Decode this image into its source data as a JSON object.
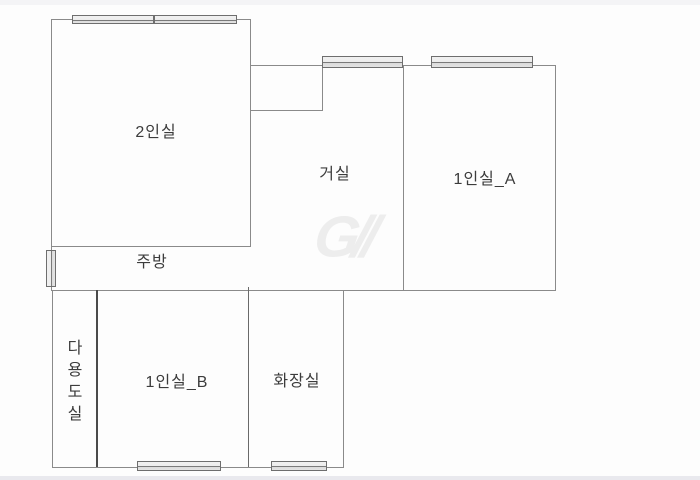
{
  "floorplan": {
    "canvas": {
      "width": 700,
      "height": 480,
      "background": "#fdfdfd"
    },
    "bands": [
      {
        "name": "top-edge-band",
        "y": 0,
        "h": 5,
        "color": "#f4f4f6"
      },
      {
        "name": "bottom-edge-band",
        "y": 476,
        "h": 4,
        "color": "#e9e9ee"
      }
    ],
    "wall_default_color": "#8a8a8a",
    "walls": [
      {
        "name": "room2in-top-wall",
        "x": 51,
        "y": 19,
        "w": 200,
        "h": 1
      },
      {
        "name": "room2in-left-wall",
        "x": 51,
        "y": 19,
        "w": 1,
        "h": 228
      },
      {
        "name": "room2in-right-wall",
        "x": 250,
        "y": 19,
        "w": 1,
        "h": 228
      },
      {
        "name": "room2in-bottom-wall",
        "x": 51,
        "y": 246,
        "w": 200,
        "h": 1
      },
      {
        "name": "upper-top-wall",
        "x": 250,
        "y": 65,
        "w": 306,
        "h": 1
      },
      {
        "name": "notch-right-wall",
        "x": 322,
        "y": 65,
        "w": 1,
        "h": 46
      },
      {
        "name": "notch-bottom-wall",
        "x": 250,
        "y": 110,
        "w": 73,
        "h": 1
      },
      {
        "name": "living-1inA-divider",
        "x": 403,
        "y": 65,
        "w": 1,
        "h": 226
      },
      {
        "name": "room1inA-right-wall",
        "x": 555,
        "y": 65,
        "w": 1,
        "h": 226
      },
      {
        "name": "mid-horizontal-wall",
        "x": 52,
        "y": 290,
        "w": 504,
        "h": 1
      },
      {
        "name": "kitchen-left-wall",
        "x": 51,
        "y": 246,
        "w": 1,
        "h": 45
      },
      {
        "name": "lower-left-wall",
        "x": 52,
        "y": 290,
        "w": 1,
        "h": 178
      },
      {
        "name": "utility-divider-wall",
        "x": 96,
        "y": 290,
        "w": 2,
        "h": 178,
        "color": "#4a4a4a"
      },
      {
        "name": "room1inB-bath-divider",
        "x": 248,
        "y": 287,
        "w": 1,
        "h": 181,
        "color": "#6a6a6a"
      },
      {
        "name": "bath-right-wall",
        "x": 343,
        "y": 291,
        "w": 1,
        "h": 177
      },
      {
        "name": "lower-bottom-wall",
        "x": 52,
        "y": 467,
        "w": 292,
        "h": 1
      }
    ],
    "windows": [
      {
        "name": "room2in-window-left",
        "x": 72,
        "y": 15,
        "w": 82,
        "h": 9,
        "vertical": false
      },
      {
        "name": "room2in-window-right",
        "x": 154,
        "y": 15,
        "w": 83,
        "h": 9,
        "vertical": false
      },
      {
        "name": "living-window",
        "x": 322,
        "y": 56,
        "w": 81,
        "h": 12,
        "vertical": false
      },
      {
        "name": "room1inA-window",
        "x": 431,
        "y": 56,
        "w": 102,
        "h": 12,
        "vertical": false
      },
      {
        "name": "kitchen-side-window",
        "x": 46,
        "y": 250,
        "w": 10,
        "h": 37,
        "vertical": true
      },
      {
        "name": "room1inB-window",
        "x": 137,
        "y": 461,
        "w": 84,
        "h": 10,
        "vertical": false
      },
      {
        "name": "bath-window",
        "x": 271,
        "y": 461,
        "w": 56,
        "h": 10,
        "vertical": false
      }
    ],
    "rooms": [
      {
        "id": "room-label-2insil",
        "label": "2인실",
        "cx": 156,
        "cy": 130,
        "vertical": false
      },
      {
        "id": "room-label-geosil",
        "label": "거실",
        "cx": 335,
        "cy": 172,
        "vertical": false
      },
      {
        "id": "room-label-1insil-a",
        "label": "1인실_A",
        "cx": 485,
        "cy": 177,
        "vertical": false
      },
      {
        "id": "room-label-jubang",
        "label": "주방",
        "cx": 152,
        "cy": 260,
        "vertical": false
      },
      {
        "id": "room-label-dayongdosil",
        "label": "다용도실",
        "cx": 72,
        "cy": 383,
        "vertical": true
      },
      {
        "id": "room-label-1insil-b",
        "label": "1인실_B",
        "cx": 177,
        "cy": 380,
        "vertical": false
      },
      {
        "id": "room-label-hwajangsil",
        "label": "화장실",
        "cx": 297,
        "cy": 379,
        "vertical": false
      }
    ],
    "watermark": {
      "text": "G//",
      "cx": 343,
      "cy": 237,
      "color": "#ededed"
    }
  }
}
